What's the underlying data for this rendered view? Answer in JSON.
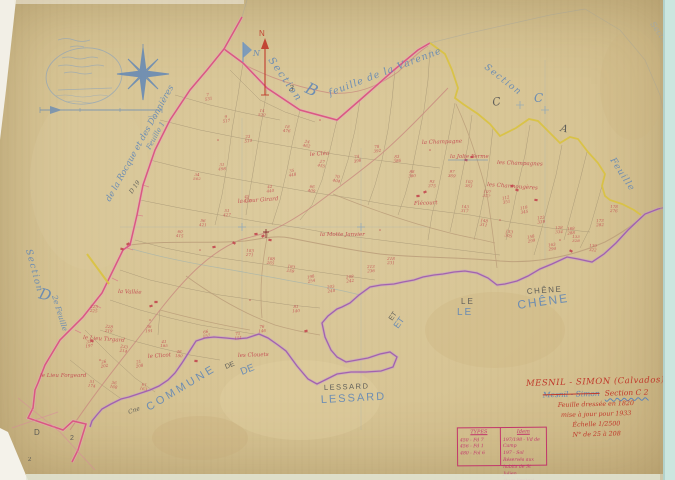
{
  "map_name": "Mesnil-Simon cadastral sheet Section C2",
  "palette": {
    "paper": "#d7c494",
    "blue_ink": "#5b84b8",
    "black_ink": "#43464b",
    "red_ink": "#c2474f",
    "title_red": "#c0392b",
    "pink_boundary": "#d84f7e",
    "yellow_boundary": "#d9c23f",
    "purple_boundary": "#9a55ae",
    "scan_edge": "#cbe6df"
  },
  "north_arrow": {
    "label": "N"
  },
  "flag": {
    "label": "N"
  },
  "map_labels": [
    {
      "t": "Section",
      "x": 268,
      "y": 60,
      "rot": 55,
      "s": 10,
      "c": "blue",
      "ls": 2,
      "i": 1
    },
    {
      "t": "B",
      "x": 304,
      "y": 92,
      "rot": 25,
      "s": 16,
      "c": "blue",
      "i": 1
    },
    {
      "t": "feuille de la Varenne",
      "x": 330,
      "y": 96,
      "rot": -21,
      "s": 9.5,
      "c": "blue",
      "ls": 1,
      "i": 1
    },
    {
      "t": "3",
      "x": 289,
      "y": 91,
      "rot": 0,
      "s": 8,
      "c": "black"
    },
    {
      "t": "Section",
      "x": 484,
      "y": 68,
      "rot": 38,
      "s": 9,
      "c": "blue",
      "ls": 1.5,
      "i": 1
    },
    {
      "t": "C",
      "x": 493,
      "y": 106,
      "rot": -10,
      "s": 11,
      "c": "black"
    },
    {
      "t": "C",
      "x": 534,
      "y": 102,
      "rot": 0,
      "s": 12,
      "c": "blue",
      "i": 1
    },
    {
      "t": "A",
      "x": 560,
      "y": 131,
      "rot": 12,
      "s": 10,
      "c": "black"
    },
    {
      "t": "Feuille",
      "x": 610,
      "y": 160,
      "rot": 57,
      "s": 9,
      "c": "blue",
      "i": 1,
      "ls": 1
    },
    {
      "t": "Section",
      "x": 650,
      "y": 24,
      "rot": 55,
      "s": 8,
      "c": "fblue",
      "i": 1
    },
    {
      "t": "Section",
      "x": 26,
      "y": 250,
      "rot": 75,
      "s": 9,
      "c": "blue",
      "i": 1,
      "ls": 1.5
    },
    {
      "t": "D",
      "x": 38,
      "y": 298,
      "rot": 15,
      "s": 15,
      "c": "blue",
      "i": 1
    },
    {
      "t": "2e Feuille",
      "x": 52,
      "y": 296,
      "rot": 73,
      "s": 7.5,
      "c": "blue",
      "i": 1
    },
    {
      "t": "de la Rocque et des Donnières",
      "x": 110,
      "y": 202,
      "rot": -61,
      "s": 8.5,
      "c": "blue",
      "i": 1
    },
    {
      "t": "Feuille 1",
      "x": 150,
      "y": 150,
      "rot": -61,
      "s": 7,
      "c": "blue",
      "i": 1
    },
    {
      "t": "D 19",
      "x": 132,
      "y": 194,
      "rot": -55,
      "s": 6,
      "c": "black"
    },
    {
      "t": "LE",
      "x": 461,
      "y": 304,
      "rot": 0,
      "s": 8,
      "c": "black",
      "f": "caps",
      "ls": 2
    },
    {
      "t": "LE",
      "x": 457,
      "y": 315,
      "rot": 0,
      "s": 10,
      "c": "blue",
      "f": "caps",
      "ls": 2
    },
    {
      "t": "CHÊNE",
      "x": 527,
      "y": 294,
      "rot": -4,
      "s": 8,
      "c": "black",
      "f": "caps",
      "ls": 1.5
    },
    {
      "t": "CHÊNE",
      "x": 518,
      "y": 309,
      "rot": -8,
      "s": 12,
      "c": "blue",
      "f": "caps",
      "ls": 2
    },
    {
      "t": "ET",
      "x": 392,
      "y": 321,
      "rot": -55,
      "s": 7,
      "c": "black",
      "f": "caps"
    },
    {
      "t": "ET",
      "x": 398,
      "y": 329,
      "rot": -55,
      "s": 9,
      "c": "blue",
      "f": "caps"
    },
    {
      "t": "LESSARD",
      "x": 324,
      "y": 390,
      "rot": -2,
      "s": 7.5,
      "c": "black",
      "f": "caps",
      "ls": 1.5
    },
    {
      "t": "LESSARD",
      "x": 321,
      "y": 403,
      "rot": -3,
      "s": 11,
      "c": "blue",
      "f": "caps",
      "ls": 2
    },
    {
      "t": "COMMUNE",
      "x": 149,
      "y": 411,
      "rot": -31,
      "s": 11,
      "c": "blue",
      "f": "caps",
      "ls": 3
    },
    {
      "t": "DE",
      "x": 226,
      "y": 369,
      "rot": -22,
      "s": 7,
      "c": "black",
      "f": "caps"
    },
    {
      "t": "DE",
      "x": 242,
      "y": 375,
      "rot": -22,
      "s": 10,
      "c": "blue",
      "f": "caps"
    },
    {
      "t": "Cne",
      "x": 129,
      "y": 414,
      "rot": -20,
      "s": 6,
      "c": "black"
    },
    {
      "t": "D",
      "x": 34,
      "y": 435,
      "rot": 0,
      "s": 8,
      "c": "black",
      "f": "caps"
    },
    {
      "t": "2",
      "x": 70,
      "y": 440,
      "rot": 0,
      "s": 7,
      "c": "black",
      "f": "caps"
    },
    {
      "t": "2",
      "x": 28,
      "y": 461,
      "rot": 0,
      "s": 6,
      "c": "black",
      "f": "caps"
    },
    {
      "t": "N",
      "x": 259,
      "y": 36,
      "rot": 0,
      "s": 8,
      "c": "red",
      "f": "caps"
    },
    {
      "t": "N",
      "x": 253,
      "y": 56,
      "rot": 0,
      "s": 8,
      "c": "blue",
      "i": 1
    }
  ],
  "place_labels": [
    {
      "t": "le Cléa",
      "x": 310,
      "y": 156
    },
    {
      "t": "la Champagne",
      "x": 422,
      "y": 144
    },
    {
      "t": "la Jolie Ferme",
      "x": 450,
      "y": 158,
      "u": 1
    },
    {
      "t": "les Champagnes",
      "x": 497,
      "y": 164
    },
    {
      "t": "les Charmougères",
      "x": 487,
      "y": 186
    },
    {
      "t": "la Cour Girard",
      "x": 238,
      "y": 203
    },
    {
      "t": "Flécourt",
      "x": 414,
      "y": 205
    },
    {
      "t": "la Motte Janvier",
      "x": 320,
      "y": 236
    },
    {
      "t": "la Vallée",
      "x": 118,
      "y": 293
    },
    {
      "t": "le Lieu Tirgard",
      "x": 83,
      "y": 339
    },
    {
      "t": "le Clicot",
      "x": 148,
      "y": 358
    },
    {
      "t": "les Clouets",
      "x": 238,
      "y": 357
    },
    {
      "t": "le Lieu Forgeard",
      "x": 40,
      "y": 377
    }
  ],
  "parcel_numbers": [
    {
      "x": 208,
      "y": 96,
      "a": "7",
      "b": "531"
    },
    {
      "x": 226,
      "y": 118,
      "a": "9",
      "b": "517"
    },
    {
      "x": 248,
      "y": 138,
      "a": "23",
      "b": "514"
    },
    {
      "x": 222,
      "y": 166,
      "a": "31",
      "b": "498"
    },
    {
      "x": 197,
      "y": 176,
      "a": "34",
      "b": "502"
    },
    {
      "x": 262,
      "y": 112,
      "a": "14",
      "b": "520"
    },
    {
      "x": 287,
      "y": 128,
      "a": "18",
      "b": "476"
    },
    {
      "x": 307,
      "y": 143,
      "a": "24",
      "b": "462"
    },
    {
      "x": 322,
      "y": 163,
      "a": "27",
      "b": "455"
    },
    {
      "x": 292,
      "y": 172,
      "a": "35",
      "b": "448"
    },
    {
      "x": 270,
      "y": 188,
      "a": "42",
      "b": "440"
    },
    {
      "x": 247,
      "y": 198,
      "a": "45",
      "b": "433"
    },
    {
      "x": 227,
      "y": 212,
      "a": "51",
      "b": "427"
    },
    {
      "x": 203,
      "y": 222,
      "a": "56",
      "b": "421"
    },
    {
      "x": 180,
      "y": 233,
      "a": "60",
      "b": "415"
    },
    {
      "x": 312,
      "y": 188,
      "a": "66",
      "b": "409"
    },
    {
      "x": 337,
      "y": 178,
      "a": "70",
      "b": "404"
    },
    {
      "x": 357,
      "y": 158,
      "a": "74",
      "b": "398"
    },
    {
      "x": 377,
      "y": 148,
      "a": "78",
      "b": "392"
    },
    {
      "x": 397,
      "y": 158,
      "a": "83",
      "b": "386"
    },
    {
      "x": 412,
      "y": 173,
      "a": "88",
      "b": "380"
    },
    {
      "x": 432,
      "y": 183,
      "a": "93",
      "b": "375"
    },
    {
      "x": 452,
      "y": 173,
      "a": "97",
      "b": "369"
    },
    {
      "x": 469,
      "y": 183,
      "a": "102",
      "b": "363"
    },
    {
      "x": 487,
      "y": 193,
      "a": "107",
      "b": "357"
    },
    {
      "x": 506,
      "y": 199,
      "a": "112",
      "b": "351"
    },
    {
      "x": 524,
      "y": 209,
      "a": "118",
      "b": "345"
    },
    {
      "x": 541,
      "y": 219,
      "a": "123",
      "b": "339"
    },
    {
      "x": 559,
      "y": 229,
      "a": "128",
      "b": "334"
    },
    {
      "x": 576,
      "y": 238,
      "a": "133",
      "b": "328"
    },
    {
      "x": 593,
      "y": 247,
      "a": "139",
      "b": "322"
    },
    {
      "x": 465,
      "y": 208,
      "a": "143",
      "b": "317"
    },
    {
      "x": 484,
      "y": 222,
      "a": "148",
      "b": "311"
    },
    {
      "x": 509,
      "y": 233,
      "a": "153",
      "b": "305"
    },
    {
      "x": 531,
      "y": 238,
      "a": "158",
      "b": "299"
    },
    {
      "x": 552,
      "y": 246,
      "a": "163",
      "b": "294"
    },
    {
      "x": 571,
      "y": 230,
      "a": "168",
      "b": "288"
    },
    {
      "x": 600,
      "y": 222,
      "a": "173",
      "b": "282"
    },
    {
      "x": 614,
      "y": 208,
      "a": "178",
      "b": "276"
    },
    {
      "x": 250,
      "y": 252,
      "a": "183",
      "b": "271"
    },
    {
      "x": 271,
      "y": 260,
      "a": "188",
      "b": "265"
    },
    {
      "x": 291,
      "y": 268,
      "a": "193",
      "b": "259"
    },
    {
      "x": 311,
      "y": 278,
      "a": "198",
      "b": "254"
    },
    {
      "x": 331,
      "y": 288,
      "a": "203",
      "b": "248"
    },
    {
      "x": 350,
      "y": 278,
      "a": "208",
      "b": "242"
    },
    {
      "x": 371,
      "y": 268,
      "a": "213",
      "b": "236"
    },
    {
      "x": 391,
      "y": 260,
      "a": "218",
      "b": "231"
    },
    {
      "x": 94,
      "y": 308,
      "a": "223",
      "b": "225"
    },
    {
      "x": 109,
      "y": 328,
      "a": "228",
      "b": "219"
    },
    {
      "x": 124,
      "y": 348,
      "a": "233",
      "b": "214"
    },
    {
      "x": 139,
      "y": 363,
      "a": "21",
      "b": "208"
    },
    {
      "x": 104,
      "y": 363,
      "a": "26",
      "b": "202"
    },
    {
      "x": 89,
      "y": 343,
      "a": "31",
      "b": "197"
    },
    {
      "x": 149,
      "y": 328,
      "a": "36",
      "b": "191"
    },
    {
      "x": 164,
      "y": 343,
      "a": "41",
      "b": "185"
    },
    {
      "x": 179,
      "y": 353,
      "a": "46",
      "b": "180"
    },
    {
      "x": 92,
      "y": 383,
      "a": "51",
      "b": "174"
    },
    {
      "x": 114,
      "y": 384,
      "a": "56",
      "b": "168"
    },
    {
      "x": 144,
      "y": 386,
      "a": "61",
      "b": "163"
    },
    {
      "x": 206,
      "y": 333,
      "a": "66",
      "b": "157"
    },
    {
      "x": 238,
      "y": 335,
      "a": "71",
      "b": "151"
    },
    {
      "x": 262,
      "y": 328,
      "a": "76",
      "b": "146"
    },
    {
      "x": 296,
      "y": 308,
      "a": "81",
      "b": "140"
    }
  ],
  "buildings": [
    {
      "x": 263,
      "y": 236
    },
    {
      "x": 270,
      "y": 240
    },
    {
      "x": 256,
      "y": 234
    },
    {
      "x": 128,
      "y": 244
    },
    {
      "x": 122,
      "y": 249
    },
    {
      "x": 418,
      "y": 196
    },
    {
      "x": 425,
      "y": 192
    },
    {
      "x": 466,
      "y": 160
    },
    {
      "x": 472,
      "y": 157
    },
    {
      "x": 512,
      "y": 186
    },
    {
      "x": 517,
      "y": 190
    },
    {
      "x": 156,
      "y": 302
    },
    {
      "x": 151,
      "y": 306
    },
    {
      "x": 92,
      "y": 341
    },
    {
      "x": 196,
      "y": 361
    },
    {
      "x": 306,
      "y": 331
    },
    {
      "x": 571,
      "y": 251
    },
    {
      "x": 536,
      "y": 200
    },
    {
      "x": 214,
      "y": 247
    },
    {
      "x": 234,
      "y": 243
    }
  ],
  "dots": [
    {
      "x": 218,
      "y": 140
    },
    {
      "x": 320,
      "y": 120
    },
    {
      "x": 430,
      "y": 150
    },
    {
      "x": 500,
      "y": 220
    },
    {
      "x": 150,
      "y": 320
    },
    {
      "x": 250,
      "y": 300
    },
    {
      "x": 380,
      "y": 230
    },
    {
      "x": 560,
      "y": 240
    },
    {
      "x": 100,
      "y": 360
    },
    {
      "x": 200,
      "y": 250
    }
  ],
  "title_block": {
    "commune": "MESNIL - SIMON (Calvados)",
    "struck_name": "Mesnil - Simon",
    "section": "Section C 2",
    "line3": "Feuille dressée en 1820",
    "line4": "mise à jour pour 1933",
    "line5": "Échelle 1/2500",
    "line6": "N° de 25 à 208"
  },
  "legend": {
    "left_header": "TYPES",
    "left_rows": [
      "450 - Fd 7",
      "456 - Fd 1",
      "480 - Fol 6"
    ],
    "right_header": "Idem",
    "right_rows": [
      "197/198 - Vd de Camp",
      "197 - Sol Réservés aux",
      "habits de St Julien",
      "(hors limites)"
    ]
  }
}
